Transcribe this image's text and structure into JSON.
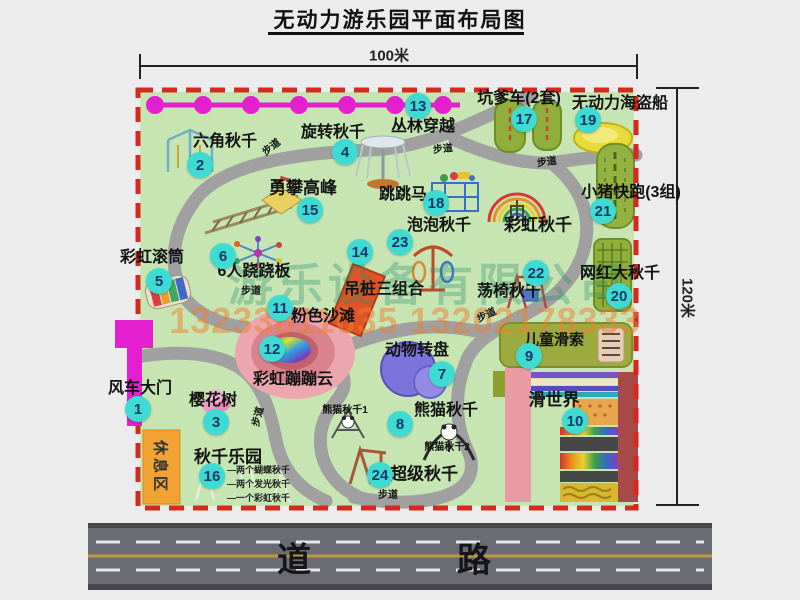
{
  "title": "无动力游乐园平面布局图",
  "dimensions": {
    "width_label": "100米",
    "height_label": "120米"
  },
  "road_label": "道　路",
  "rest_area_label": "休息区",
  "path_label_text": "步道",
  "watermark": {
    "company": "游乐设备有限公司",
    "phone": "13233811635 13202178333"
  },
  "attractions": [
    {
      "num": "1",
      "label": "风车大门",
      "circle": [
        138,
        409
      ],
      "label_pos": [
        140,
        389
      ],
      "size": 16
    },
    {
      "num": "2",
      "label": "六角秋千",
      "circle": [
        200,
        165
      ],
      "label_pos": [
        225,
        142
      ],
      "size": 16
    },
    {
      "num": "3",
      "label": "樱花树",
      "circle": [
        216,
        422
      ],
      "label_pos": [
        213,
        401
      ],
      "size": 16
    },
    {
      "num": "4",
      "label": "旋转秋千",
      "circle": [
        345,
        152
      ],
      "label_pos": [
        333,
        133
      ],
      "size": 16
    },
    {
      "num": "5",
      "label": "彩虹滚筒",
      "circle": [
        159,
        281
      ],
      "label_pos": [
        152,
        258
      ],
      "size": 16
    },
    {
      "num": "6",
      "label": "6人跷跷板",
      "circle": [
        223,
        256
      ],
      "label_pos": [
        254,
        272
      ],
      "size": 16
    },
    {
      "num": "7",
      "label": "动物转盘",
      "circle": [
        442,
        374
      ],
      "label_pos": [
        417,
        351
      ],
      "size": 16
    },
    {
      "num": "8",
      "label": "熊猫秋千",
      "circle": [
        400,
        424
      ],
      "label_pos": [
        446,
        411
      ],
      "size": 16
    },
    {
      "num": "9",
      "label": "儿童滑索",
      "circle": [
        529,
        356
      ],
      "label_pos": [
        554,
        340
      ],
      "size": 15
    },
    {
      "num": "10",
      "label": "滑世界",
      "circle": [
        575,
        421
      ],
      "label_pos": [
        554,
        400
      ],
      "size": 17
    },
    {
      "num": "11",
      "label": "粉色沙滩",
      "circle": [
        280,
        308
      ],
      "label_pos": [
        323,
        317
      ],
      "size": 16
    },
    {
      "num": "12",
      "label": "彩虹蹦蹦云",
      "circle": [
        272,
        349
      ],
      "label_pos": [
        293,
        380
      ],
      "size": 16
    },
    {
      "num": "13",
      "label": "丛林穿越",
      "circle": [
        418,
        106
      ],
      "label_pos": [
        423,
        127
      ],
      "size": 16
    },
    {
      "num": "14",
      "label": "吊桩三组合",
      "circle": [
        360,
        252
      ],
      "label_pos": [
        384,
        290
      ],
      "size": 16
    },
    {
      "num": "15",
      "label": "勇攀高峰",
      "circle": [
        310,
        210
      ],
      "label_pos": [
        303,
        188
      ],
      "size": 17
    },
    {
      "num": "16",
      "label": "秋千乐园",
      "circle": [
        212,
        476
      ],
      "label_pos": [
        228,
        457
      ],
      "size": 17
    },
    {
      "num": "17",
      "label": "坑爹车(2套)",
      "circle": [
        524,
        119
      ],
      "label_pos": [
        519,
        99
      ],
      "size": 16
    },
    {
      "num": "18",
      "label": "跳跳马",
      "circle": [
        436,
        203
      ],
      "label_pos": [
        403,
        195
      ],
      "size": 16
    },
    {
      "num": "19",
      "label": "无动力海盗船",
      "circle": [
        588,
        120
      ],
      "label_pos": [
        620,
        104
      ],
      "size": 16
    },
    {
      "num": "20",
      "label": "网红大秋千",
      "circle": [
        619,
        296
      ],
      "label_pos": [
        620,
        274
      ],
      "size": 16
    },
    {
      "num": "21",
      "label": "小猪快跑(3组)",
      "circle": [
        603,
        211
      ],
      "label_pos": [
        631,
        193
      ],
      "size": 16
    },
    {
      "num": "22",
      "label": "荡椅秋千",
      "circle": [
        536,
        273
      ],
      "label_pos": [
        509,
        292
      ],
      "size": 16
    },
    {
      "num": "23",
      "label": "泡泡秋千",
      "circle": [
        400,
        242
      ],
      "label_pos": [
        439,
        226
      ],
      "size": 16
    },
    {
      "num": "24",
      "label": "超级秋千",
      "circle": [
        380,
        475
      ],
      "label_pos": [
        424,
        474
      ],
      "size": 17
    },
    {
      "num": null,
      "label": "彩虹秋千",
      "circle": null,
      "label_pos": [
        538,
        225
      ],
      "size": 17
    }
  ],
  "extra_labels": [
    {
      "text": "熊猫秋千1",
      "x": 345,
      "y": 411,
      "size": 10
    },
    {
      "text": "熊猫秋千2",
      "x": 447,
      "y": 448,
      "size": 10
    }
  ],
  "swing_park_notes": {
    "x": 227,
    "y": 466,
    "line_height": 14,
    "items": [
      "两个蝴蝶秋千",
      "两个发光秋千",
      "一个彩虹秋千"
    ]
  },
  "path_labels": [
    {
      "x": 272,
      "y": 148,
      "rot": -38
    },
    {
      "x": 443,
      "y": 150,
      "rot": -6
    },
    {
      "x": 547,
      "y": 163,
      "rot": -8
    },
    {
      "x": 251,
      "y": 292,
      "rot": 0
    },
    {
      "x": 259,
      "y": 417,
      "rot": -75
    },
    {
      "x": 487,
      "y": 316,
      "rot": -25
    },
    {
      "x": 388,
      "y": 496,
      "rot": 0
    }
  ],
  "colors": {
    "map_green": "#c6e5b3",
    "border_red": "#d42a1e",
    "marker_teal": "#3edbd2",
    "magenta": "#e41fd0",
    "road_gray": "#6b6b73"
  }
}
